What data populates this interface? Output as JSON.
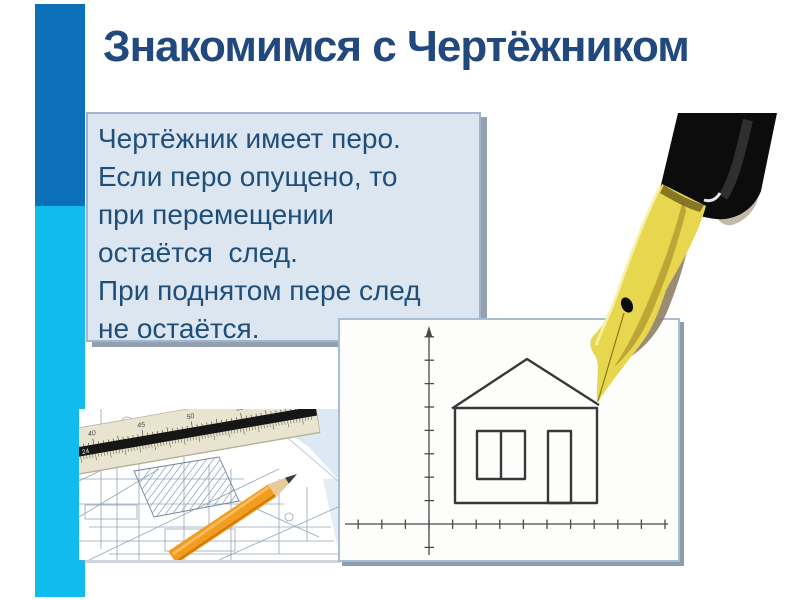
{
  "slide": {
    "title": "Знакомимся с Чертёжником"
  },
  "note_box": {
    "lines": [
      "Чертёжник имеет перо.",
      "Если перо опущено, то",
      "при перемещении",
      "остаётся  след.",
      "При поднятом пере след",
      "не остаётся."
    ]
  },
  "photo": {
    "ruler_numbers": [
      "40",
      "45",
      "50",
      "55",
      "60"
    ],
    "ruler_mark": "24",
    "ruler_end_label": "604-I"
  },
  "colors": {
    "title_text": "#21497e",
    "note_text": "#1f4e79",
    "note_bg": "#dce6f1",
    "bar_top": "#0b70b8",
    "bar_bottom": "#10bcec",
    "pen_body": "#0c0c0c",
    "pen_nib": "#e6d74f",
    "pencil": "#f29d1f"
  }
}
